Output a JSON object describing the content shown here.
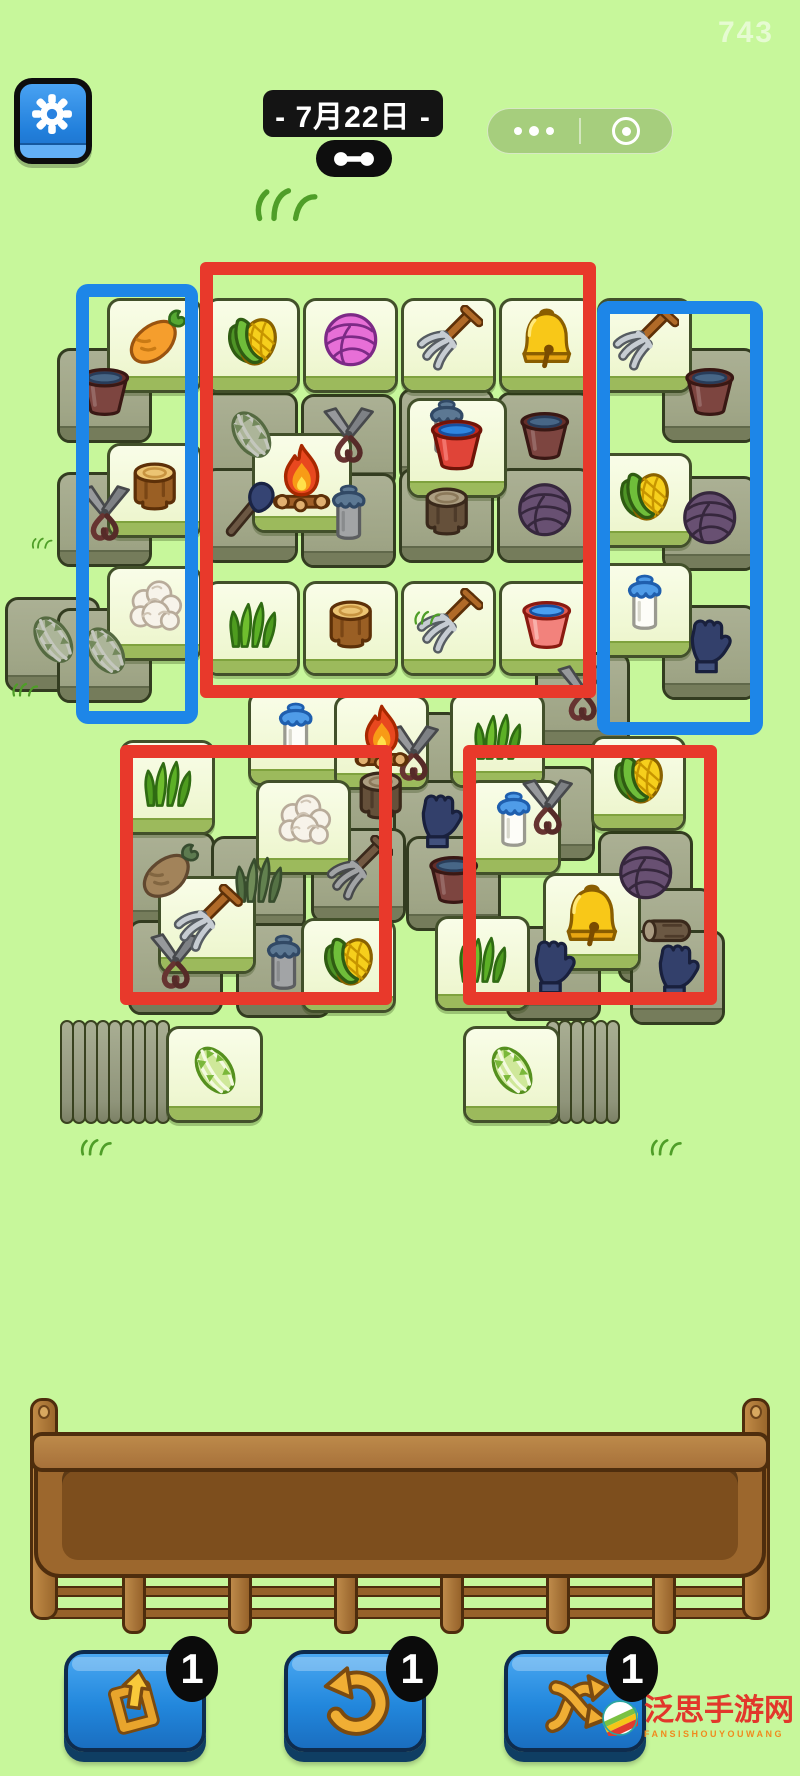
{
  "header": {
    "session_number": "743",
    "date_label": "- 7月22日 -"
  },
  "colors": {
    "background": "#c7f79b",
    "annotation_red": "#e8392b",
    "annotation_blue": "#1d86e8",
    "tile_bright": "#f4fadd",
    "tile_dark": "#a3a88d",
    "button_blue": "#2287dc",
    "tray_brown": "#9c672d"
  },
  "board": {
    "tiles": [
      {
        "n": "bucket-red",
        "v": "d",
        "x": 57,
        "y": 348
      },
      {
        "n": "bucket-red",
        "v": "d",
        "x": 662,
        "y": 348
      },
      {
        "n": "cabbage",
        "v": "d",
        "x": 203,
        "y": 392
      },
      {
        "n": "shears",
        "v": "d",
        "x": 301,
        "y": 394
      },
      {
        "n": "milk",
        "v": "d",
        "x": 399,
        "y": 388
      },
      {
        "n": "bucket-red",
        "v": "d",
        "x": 497,
        "y": 392
      },
      {
        "n": "shears",
        "v": "d",
        "x": 57,
        "y": 472
      },
      {
        "n": "shovel",
        "v": "d",
        "x": 203,
        "y": 468
      },
      {
        "n": "can-gray",
        "v": "d",
        "x": 301,
        "y": 473
      },
      {
        "n": "stump",
        "v": "d",
        "x": 399,
        "y": 468
      },
      {
        "n": "yarn-purple",
        "v": "d",
        "x": 497,
        "y": 468
      },
      {
        "n": "yarn-purple",
        "v": "d",
        "x": 662,
        "y": 476
      },
      {
        "n": "cabbage",
        "v": "d",
        "x": 5,
        "y": 597
      },
      {
        "n": "cabbage",
        "v": "d",
        "x": 57,
        "y": 608
      },
      {
        "n": "glove",
        "v": "d",
        "x": 662,
        "y": 605
      },
      {
        "n": "shears",
        "v": "d",
        "x": 535,
        "y": 652
      },
      {
        "n": "shears",
        "v": "d",
        "x": 366,
        "y": 712
      },
      {
        "n": "stump",
        "v": "d",
        "x": 333,
        "y": 752
      },
      {
        "n": "shears",
        "v": "d",
        "x": 500,
        "y": 766
      },
      {
        "n": "glove",
        "v": "d",
        "x": 393,
        "y": 780
      },
      {
        "n": "pitchfork",
        "v": "d",
        "x": 311,
        "y": 828
      },
      {
        "n": "yarn-purple",
        "v": "d",
        "x": 598,
        "y": 831
      },
      {
        "n": "carrot",
        "v": "d",
        "x": 120,
        "y": 832
      },
      {
        "n": "grass",
        "v": "d",
        "x": 211,
        "y": 836
      },
      {
        "n": "bucket-red",
        "v": "d",
        "x": 406,
        "y": 836
      },
      {
        "n": "log",
        "v": "d",
        "x": 618,
        "y": 888
      },
      {
        "n": "shears",
        "v": "d",
        "x": 128,
        "y": 920
      },
      {
        "n": "can-gray",
        "v": "d",
        "x": 236,
        "y": 923
      },
      {
        "n": "glove",
        "v": "d",
        "x": 506,
        "y": 926
      },
      {
        "n": "glove",
        "v": "d",
        "x": 630,
        "y": 930
      },
      {
        "n": "carrot",
        "v": "b",
        "x": 107,
        "y": 298
      },
      {
        "n": "corn",
        "v": "b",
        "x": 205,
        "y": 298
      },
      {
        "n": "yarn-pink",
        "v": "b",
        "x": 303,
        "y": 298
      },
      {
        "n": "pitchfork",
        "v": "b",
        "x": 401,
        "y": 298
      },
      {
        "n": "bell",
        "v": "b",
        "x": 499,
        "y": 298
      },
      {
        "n": "pitchfork",
        "v": "b",
        "x": 597,
        "y": 298
      },
      {
        "n": "bucket-red",
        "v": "b",
        "x": 407,
        "y": 398,
        "s": 100
      },
      {
        "n": "fire",
        "v": "b",
        "x": 252,
        "y": 433,
        "s": 100
      },
      {
        "n": "stump",
        "v": "b",
        "x": 107,
        "y": 443
      },
      {
        "n": "corn",
        "v": "b",
        "x": 597,
        "y": 453
      },
      {
        "n": "milk",
        "v": "b",
        "x": 597,
        "y": 563
      },
      {
        "n": "cauliflower",
        "v": "b",
        "x": 107,
        "y": 566
      },
      {
        "n": "grass",
        "v": "b",
        "x": 205,
        "y": 581
      },
      {
        "n": "stump",
        "v": "b",
        "x": 303,
        "y": 581
      },
      {
        "n": "pitchfork",
        "v": "b",
        "x": 401,
        "y": 581
      },
      {
        "n": "bucket-pink",
        "v": "b",
        "x": 499,
        "y": 581
      },
      {
        "n": "milk",
        "v": "b",
        "x": 248,
        "y": 691
      },
      {
        "n": "grass",
        "v": "b",
        "x": 450,
        "y": 693
      },
      {
        "n": "fire",
        "v": "b",
        "x": 334,
        "y": 695
      },
      {
        "n": "corn",
        "v": "b",
        "x": 591,
        "y": 736
      },
      {
        "n": "grass",
        "v": "b",
        "x": 120,
        "y": 740
      },
      {
        "n": "cauliflower",
        "v": "b",
        "x": 256,
        "y": 780
      },
      {
        "n": "milk",
        "v": "b",
        "x": 466,
        "y": 780
      },
      {
        "n": "bell",
        "v": "b",
        "x": 543,
        "y": 873,
        "s": 98
      },
      {
        "n": "pitchfork",
        "v": "b",
        "x": 158,
        "y": 876,
        "s": 98
      },
      {
        "n": "grass",
        "v": "b",
        "x": 435,
        "y": 916
      },
      {
        "n": "corn",
        "v": "b",
        "x": 301,
        "y": 918
      },
      {
        "n": "cabbage",
        "v": "b",
        "x": 166,
        "y": 1026,
        "s": 97,
        "z": 60
      },
      {
        "n": "cabbage",
        "v": "b",
        "x": 463,
        "y": 1026,
        "s": 97,
        "z": 60
      }
    ],
    "stacks": [
      {
        "x": 60,
        "y": 1020,
        "count": 9,
        "gap": 12
      },
      {
        "x": 546,
        "y": 1020,
        "count": 6,
        "gap": 12
      }
    ],
    "annotations": [
      {
        "c": "red",
        "x": 200,
        "y": 262,
        "w": 396,
        "h": 436
      },
      {
        "c": "blue",
        "x": 76,
        "y": 284,
        "w": 122,
        "h": 440
      },
      {
        "c": "blue",
        "x": 597,
        "y": 301,
        "w": 166,
        "h": 434
      },
      {
        "c": "red",
        "x": 120,
        "y": 745,
        "w": 272,
        "h": 260
      },
      {
        "c": "red",
        "x": 463,
        "y": 745,
        "w": 254,
        "h": 260
      }
    ],
    "doodles": [
      {
        "x": 250,
        "y": 186,
        "w": 72
      },
      {
        "x": 30,
        "y": 536,
        "w": 24
      },
      {
        "x": 10,
        "y": 682,
        "w": 30
      },
      {
        "x": 412,
        "y": 610,
        "w": 30
      },
      {
        "x": 78,
        "y": 1138,
        "w": 36
      },
      {
        "x": 648,
        "y": 1138,
        "w": 36
      }
    ]
  },
  "tray": {
    "small_post_centers": [
      134,
      240,
      346,
      452,
      558,
      664
    ],
    "tall_posts": [
      {
        "x": 30,
        "y": 1398,
        "h": 222
      },
      {
        "x": 742,
        "y": 1398,
        "h": 222
      }
    ],
    "rails_y": [
      1562,
      1586,
      1608
    ]
  },
  "buttons": [
    {
      "name": "extra-slot-button",
      "icon": "pop-out",
      "count": "1",
      "x": 64
    },
    {
      "name": "undo-button",
      "icon": "undo",
      "count": "1",
      "x": 284
    },
    {
      "name": "shuffle-button",
      "icon": "shuffle",
      "count": "1",
      "x": 504
    }
  ],
  "watermark": {
    "site_name": "泛思手游网",
    "site_latin": "FANSISHOUYOUWANG"
  }
}
